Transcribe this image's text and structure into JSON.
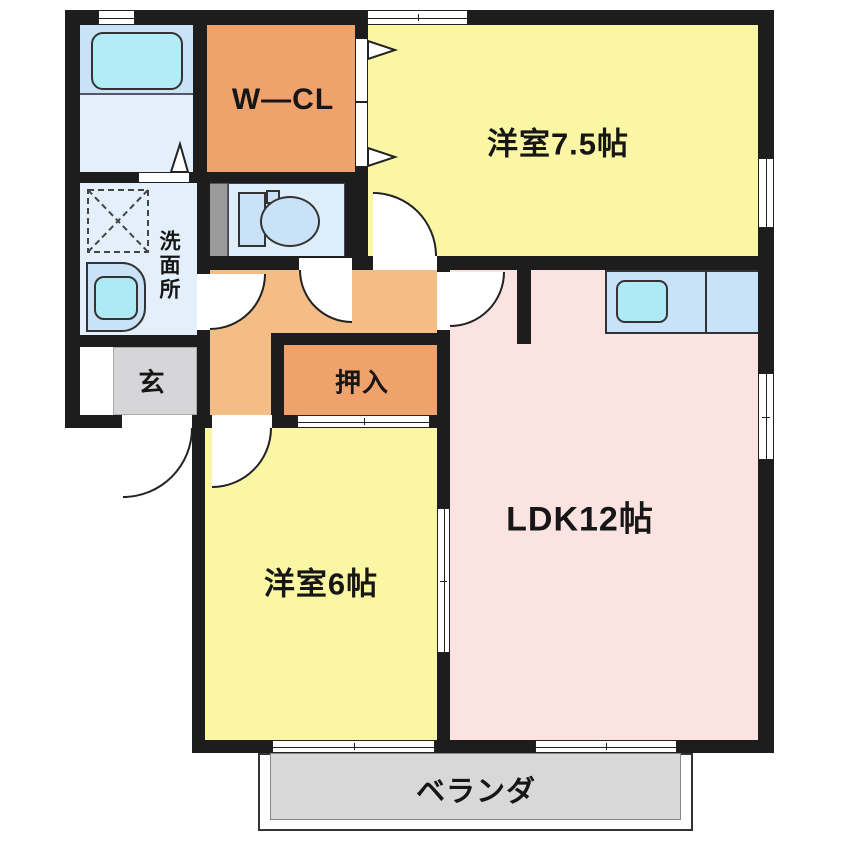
{
  "floorplan": {
    "rooms": {
      "walk_in_closet": {
        "label": "W—CL"
      },
      "western_room_7_5": {
        "label": "洋室7.5帖"
      },
      "washroom": {
        "label": "洗面所"
      },
      "entrance": {
        "label": "玄"
      },
      "closet": {
        "label": "押入"
      },
      "western_room_6": {
        "label": "洋室6帖"
      },
      "ldk": {
        "label": "LDK12帖"
      },
      "veranda": {
        "label": "ベランダ"
      }
    },
    "colors": {
      "wall": "#1d1d1d",
      "room_yellow": "#faf6a4",
      "room_pink": "#fbe3e1",
      "hall_orange": "#f4bd85",
      "closet_orange": "#f0a26c",
      "entrance_gray": "#d6d6d8",
      "veranda_gray": "#d8d8d8",
      "water_blue": "#c9e2f6",
      "bath_light": "#e3f0fb",
      "fixture_cyan": "#aeeaf6"
    }
  }
}
